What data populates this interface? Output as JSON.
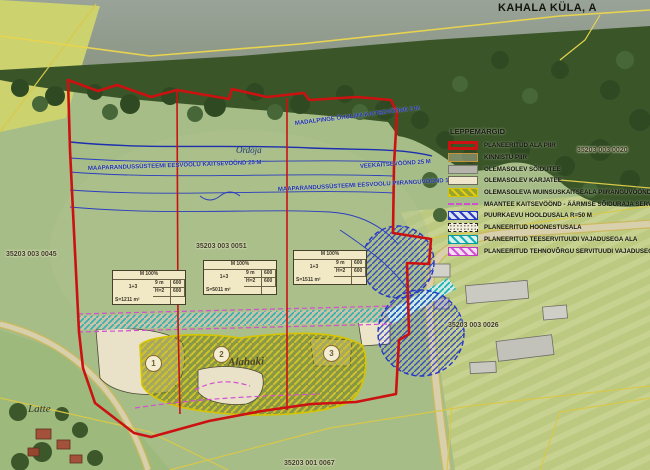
{
  "title": "KAHALA KÜLA, A",
  "legend": {
    "title": "LEPPEMÄRGID",
    "items": [
      {
        "key": "planned-area-border",
        "label": "PLANEERITUD ALA PIIR"
      },
      {
        "key": "property-border",
        "label": "KINNISTU PIIR"
      },
      {
        "key": "existing-road",
        "label": "OLEMASOLEV SÕIDUTEE"
      },
      {
        "key": "existing-track",
        "label": "OLEMASOLEV KARJATEE"
      },
      {
        "key": "heritage-zone",
        "label": "OLEMASOLEVA MUINSUSKAITSEALA PIIRANGUVÖÖND"
      },
      {
        "key": "road-protection-zone",
        "label": "MAANTEE KAITSEVÖÖND - ÄÄRMISE SÕIDURAJA SERVAST 50 M"
      },
      {
        "key": "well-maintenance",
        "label": "PUURKAEVU HOOLDUSALA R=50 M"
      },
      {
        "key": "planned-building",
        "label": "PLANEERITUD HOONESTUSALA"
      },
      {
        "key": "road-servitude",
        "label": "PLANEERITUD TEESERVITUUDI VAJADUSEGA ALA"
      },
      {
        "key": "utility-servitude",
        "label": "PLANEERITUD TEHNOVÕRGU SERVITUUDI VAJADUSEGA ALA"
      }
    ]
  },
  "map_labels": {
    "cadastral": [
      {
        "text": "35203 003 0045"
      },
      {
        "text": "35203 003 0051"
      },
      {
        "text": "35203 003 0020"
      },
      {
        "text": "35203 003 0026"
      },
      {
        "text": "35203 001 0067"
      }
    ],
    "places": {
      "stream": "Ordoja",
      "heritage_site": "Alahaki",
      "farm": "Latte"
    },
    "restrictions": [
      {
        "text": "MAAPARANDUSSÜSTEEMI EESVOOLU KAITSEVÖÖND 25 M"
      },
      {
        "text": "MADALPINGE ÕHULIINI KAITSEVÖÖND 2 M"
      },
      {
        "text": "VEEKAITSEVÖÖND 25 M"
      },
      {
        "text": "MAAPARANDUSSÜSTEEMI EESVOOLU PIIRANGUVÖÖND 100 M"
      }
    ],
    "plots": [
      {
        "num": "1"
      },
      {
        "num": "2"
      },
      {
        "num": "3"
      }
    ]
  },
  "plot_tables": [
    {
      "header": "M 100%",
      "r1l": "9 m",
      "r1v": "600",
      "r2l": "H=2",
      "r2v": "600",
      "area": "S=1211 m²",
      "side": "1+3"
    },
    {
      "header": "M 100%",
      "r1l": "9 m",
      "r1v": "600",
      "r2l": "H=2",
      "r2v": "600",
      "area": "S=5011 m²",
      "side": "1+3"
    },
    {
      "header": "M 100%",
      "r1l": "9 m",
      "r1v": "600",
      "r2l": "H=2",
      "r2v": "600",
      "area": "S=1511 m²",
      "side": "1+3"
    }
  ],
  "colors": {
    "planned_area_red": "#cc1111",
    "drainage_blue": "#2233bb",
    "servitude_cyan": "#14b4b4",
    "utility_magenta": "#d24fd2",
    "heritage_yellow": "#d6c400"
  }
}
